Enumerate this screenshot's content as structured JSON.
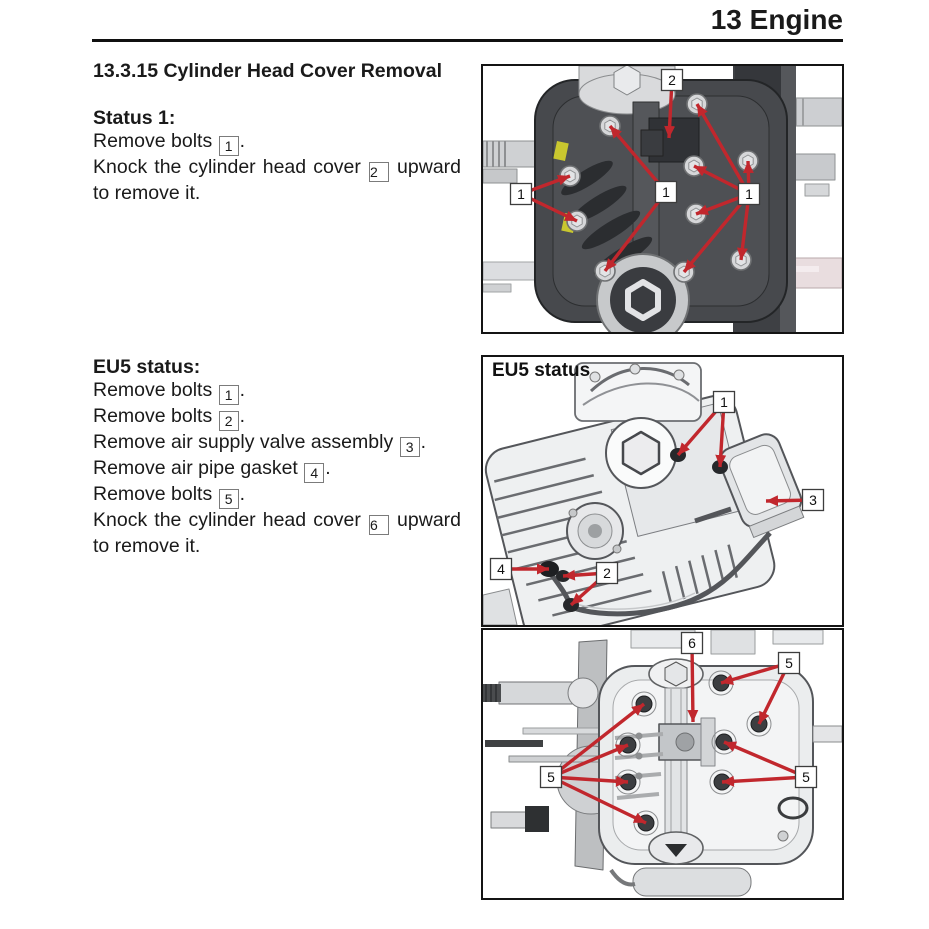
{
  "colors": {
    "arrow_red": "#c1272d",
    "figure_border": "#141414",
    "yellow_accent": "#c9c72f"
  },
  "header": {
    "title": "13 Engine"
  },
  "article": {
    "section_title": "13.3.15 Cylinder Head Cover Removal",
    "blocks": [
      {
        "heading": "Status 1:",
        "lines": [
          {
            "text": "Remove bolts [1].",
            "justify": false
          },
          {
            "text": "Knock the cylinder head cover [2] upward",
            "justify": true
          },
          {
            "text": "to remove it.",
            "justify": false
          }
        ]
      },
      {
        "heading": "EU5 status:",
        "lines": [
          {
            "text": "Remove bolts [1].",
            "justify": false
          },
          {
            "text": "Remove bolts [2].",
            "justify": false
          },
          {
            "text": "Remove air supply valve assembly [3].",
            "justify": false
          },
          {
            "text": "Remove air pipe gasket [4].",
            "justify": false
          },
          {
            "text": "Remove bolts [5].",
            "justify": false
          },
          {
            "text": "Knock the cylinder head cover [6] upward",
            "justify": true
          },
          {
            "text": "to remove it.",
            "justify": false
          }
        ]
      }
    ]
  },
  "figures": [
    {
      "name": "cylinder-head-cover-status1",
      "label": "",
      "callouts": [
        {
          "label": "2",
          "box": [
            189,
            14
          ],
          "targets": [
            [
              186,
              72
            ]
          ]
        },
        {
          "label": "1",
          "box": [
            38,
            128
          ],
          "targets": [
            [
              87,
              110
            ],
            [
              94,
              155
            ]
          ]
        },
        {
          "label": "1",
          "box": [
            183,
            126
          ],
          "targets": [
            [
              127,
              60
            ],
            [
              122,
              205
            ]
          ]
        },
        {
          "label": "1",
          "box": [
            266,
            128
          ],
          "targets": [
            [
              214,
              38
            ],
            [
              211,
              100
            ],
            [
              213,
              148
            ],
            [
              201,
              206
            ],
            [
              265,
              95
            ],
            [
              258,
              194
            ]
          ]
        }
      ]
    },
    {
      "name": "cylinder-head-eu5-upper",
      "label": "EU5 status",
      "callouts": [
        {
          "label": "1",
          "box": [
            241,
            45
          ],
          "targets": [
            [
              195,
              98
            ],
            [
              237,
              110
            ]
          ]
        },
        {
          "label": "3",
          "box": [
            330,
            143
          ],
          "targets": [
            [
              283,
              144
            ]
          ]
        },
        {
          "label": "4",
          "box": [
            18,
            212
          ],
          "targets": [
            [
              66,
              212
            ]
          ]
        },
        {
          "label": "2",
          "box": [
            124,
            216
          ],
          "targets": [
            [
              80,
              219
            ],
            [
              88,
              248
            ]
          ]
        }
      ]
    },
    {
      "name": "cylinder-head-eu5-lower",
      "label": "",
      "callouts": [
        {
          "label": "6",
          "box": [
            209,
            13
          ],
          "targets": [
            [
              210,
              92
            ]
          ]
        },
        {
          "label": "5",
          "box": [
            306,
            33
          ],
          "targets": [
            [
              238,
              53
            ],
            [
              276,
              94
            ]
          ]
        },
        {
          "label": "5",
          "box": [
            68,
            147
          ],
          "targets": [
            [
              161,
              74
            ],
            [
              145,
              115
            ],
            [
              145,
              152
            ],
            [
              163,
              193
            ]
          ]
        },
        {
          "label": "5",
          "box": [
            323,
            147
          ],
          "targets": [
            [
              241,
              112
            ],
            [
              239,
              152
            ]
          ]
        }
      ]
    }
  ]
}
